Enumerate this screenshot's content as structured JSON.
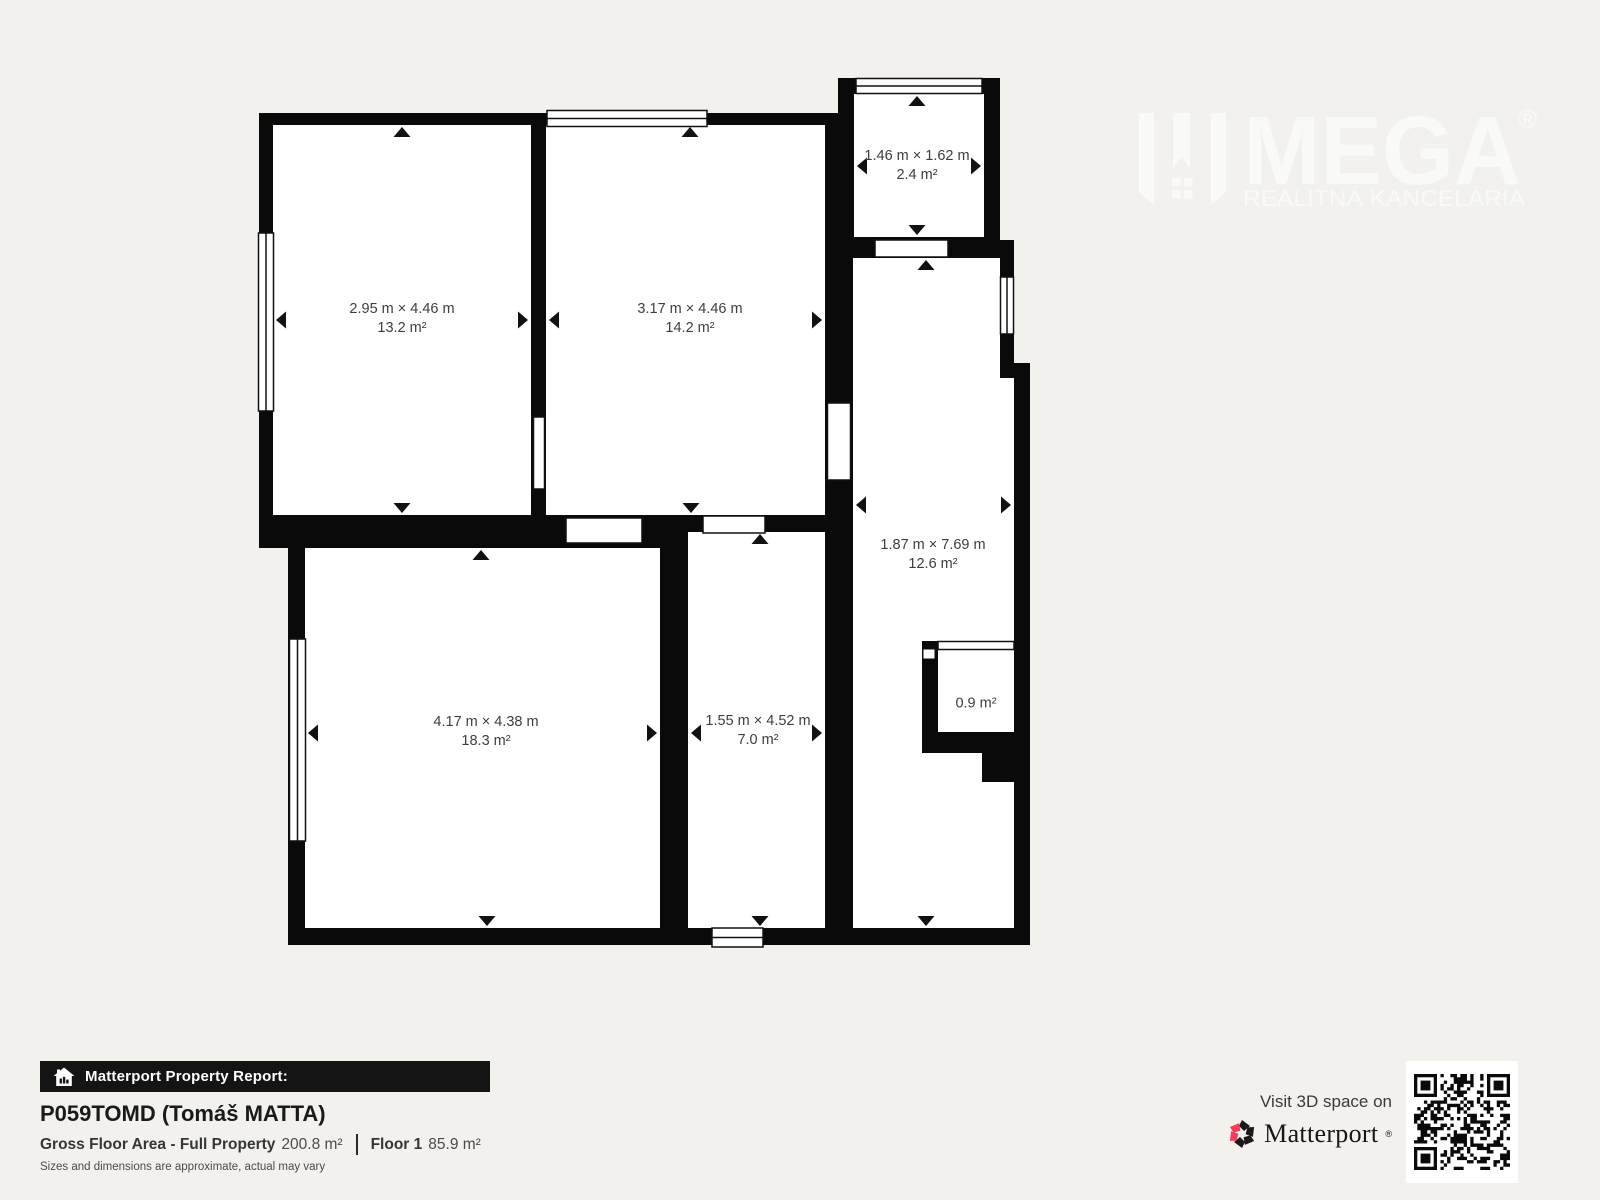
{
  "colors": {
    "wall": "#0a0a0a",
    "background": "#f2f1ee",
    "room_fill": "#ffffff",
    "label_text": "#3d3d3d",
    "matterport_pink": "#f43e5c"
  },
  "floor_plan": {
    "rooms": [
      {
        "name": "top-left-room",
        "dims": "2.95 m × 4.46 m",
        "area": "13.2 m²"
      },
      {
        "name": "top-middle-room",
        "dims": "3.17 m × 4.46 m",
        "area": "14.2 m²"
      },
      {
        "name": "small-top-room",
        "dims": "1.46 m × 1.62 m",
        "area": "2.4 m²"
      },
      {
        "name": "tall-right-room",
        "dims": "1.87 m × 7.69 m",
        "area": "12.6 m²"
      },
      {
        "name": "bottom-left-room",
        "dims": "4.17 m × 4.38 m",
        "area": "18.3 m²"
      },
      {
        "name": "bottom-mid-room",
        "dims": "1.55 m × 4.52 m",
        "area": "7.0 m²"
      },
      {
        "name": "closet",
        "dims": "",
        "area": "0.9 m²"
      }
    ]
  },
  "watermark": {
    "brand": "MEGA",
    "registered": "®",
    "tagline": "REALITNÁ KANCELÁRIA"
  },
  "report": {
    "banner": "Matterport Property Report:",
    "title": "P059TOMD (Tomáš MATTA)",
    "gross_label": "Gross Floor Area - Full Property",
    "gross_value": "200.8 m²",
    "floor_label": "Floor 1",
    "floor_value": "85.9 m²",
    "disclaimer": "Sizes and dimensions are approximate, actual may vary"
  },
  "matterport_promo": {
    "visit_text": "Visit 3D space on",
    "brand": "Matterport",
    "registered": "®"
  }
}
